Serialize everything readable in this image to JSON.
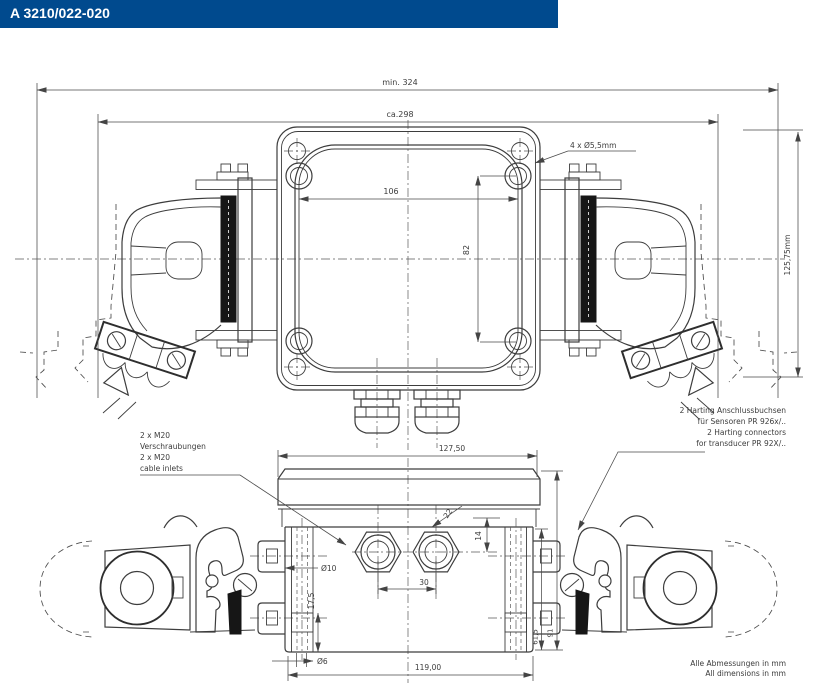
{
  "header": {
    "title": "A 3210/022-020",
    "bar_color": "#004a8e"
  },
  "drawing": {
    "top_view": {
      "dim_min_width": "min. 324",
      "dim_approx_width": "ca.298",
      "dim_hole_spacing_h": "106",
      "dim_hole_spacing_v": "82",
      "callout_corner_holes": "4 x Ø5,5mm",
      "dim_height": "125,75mm"
    },
    "front_view": {
      "dim_lid_width": "127,50",
      "dim_gland_spacing": "30",
      "dim_gland_size": "22",
      "dim_gland_offset": "14",
      "dim_tab_hole": "Ø10",
      "dim_pocket_depth": "17,5",
      "dim_bottom_hole": "Ø6",
      "dim_body_width": "119,00",
      "dim_height_inner": "61,5",
      "dim_height_outer": "91"
    },
    "labels": {
      "cable_inlets": [
        "2 x M20",
        "Verschraubungen",
        "2 x M20",
        "cable inlets"
      ],
      "connectors": [
        "2 Harting Anschlussbuchsen",
        "für Sensoren PR 926x/..",
        "2 Harting connectors",
        "for transducer PR 92X/.."
      ],
      "note": [
        "Alle Abmessungen in mm",
        "All dimensions in mm"
      ]
    }
  }
}
